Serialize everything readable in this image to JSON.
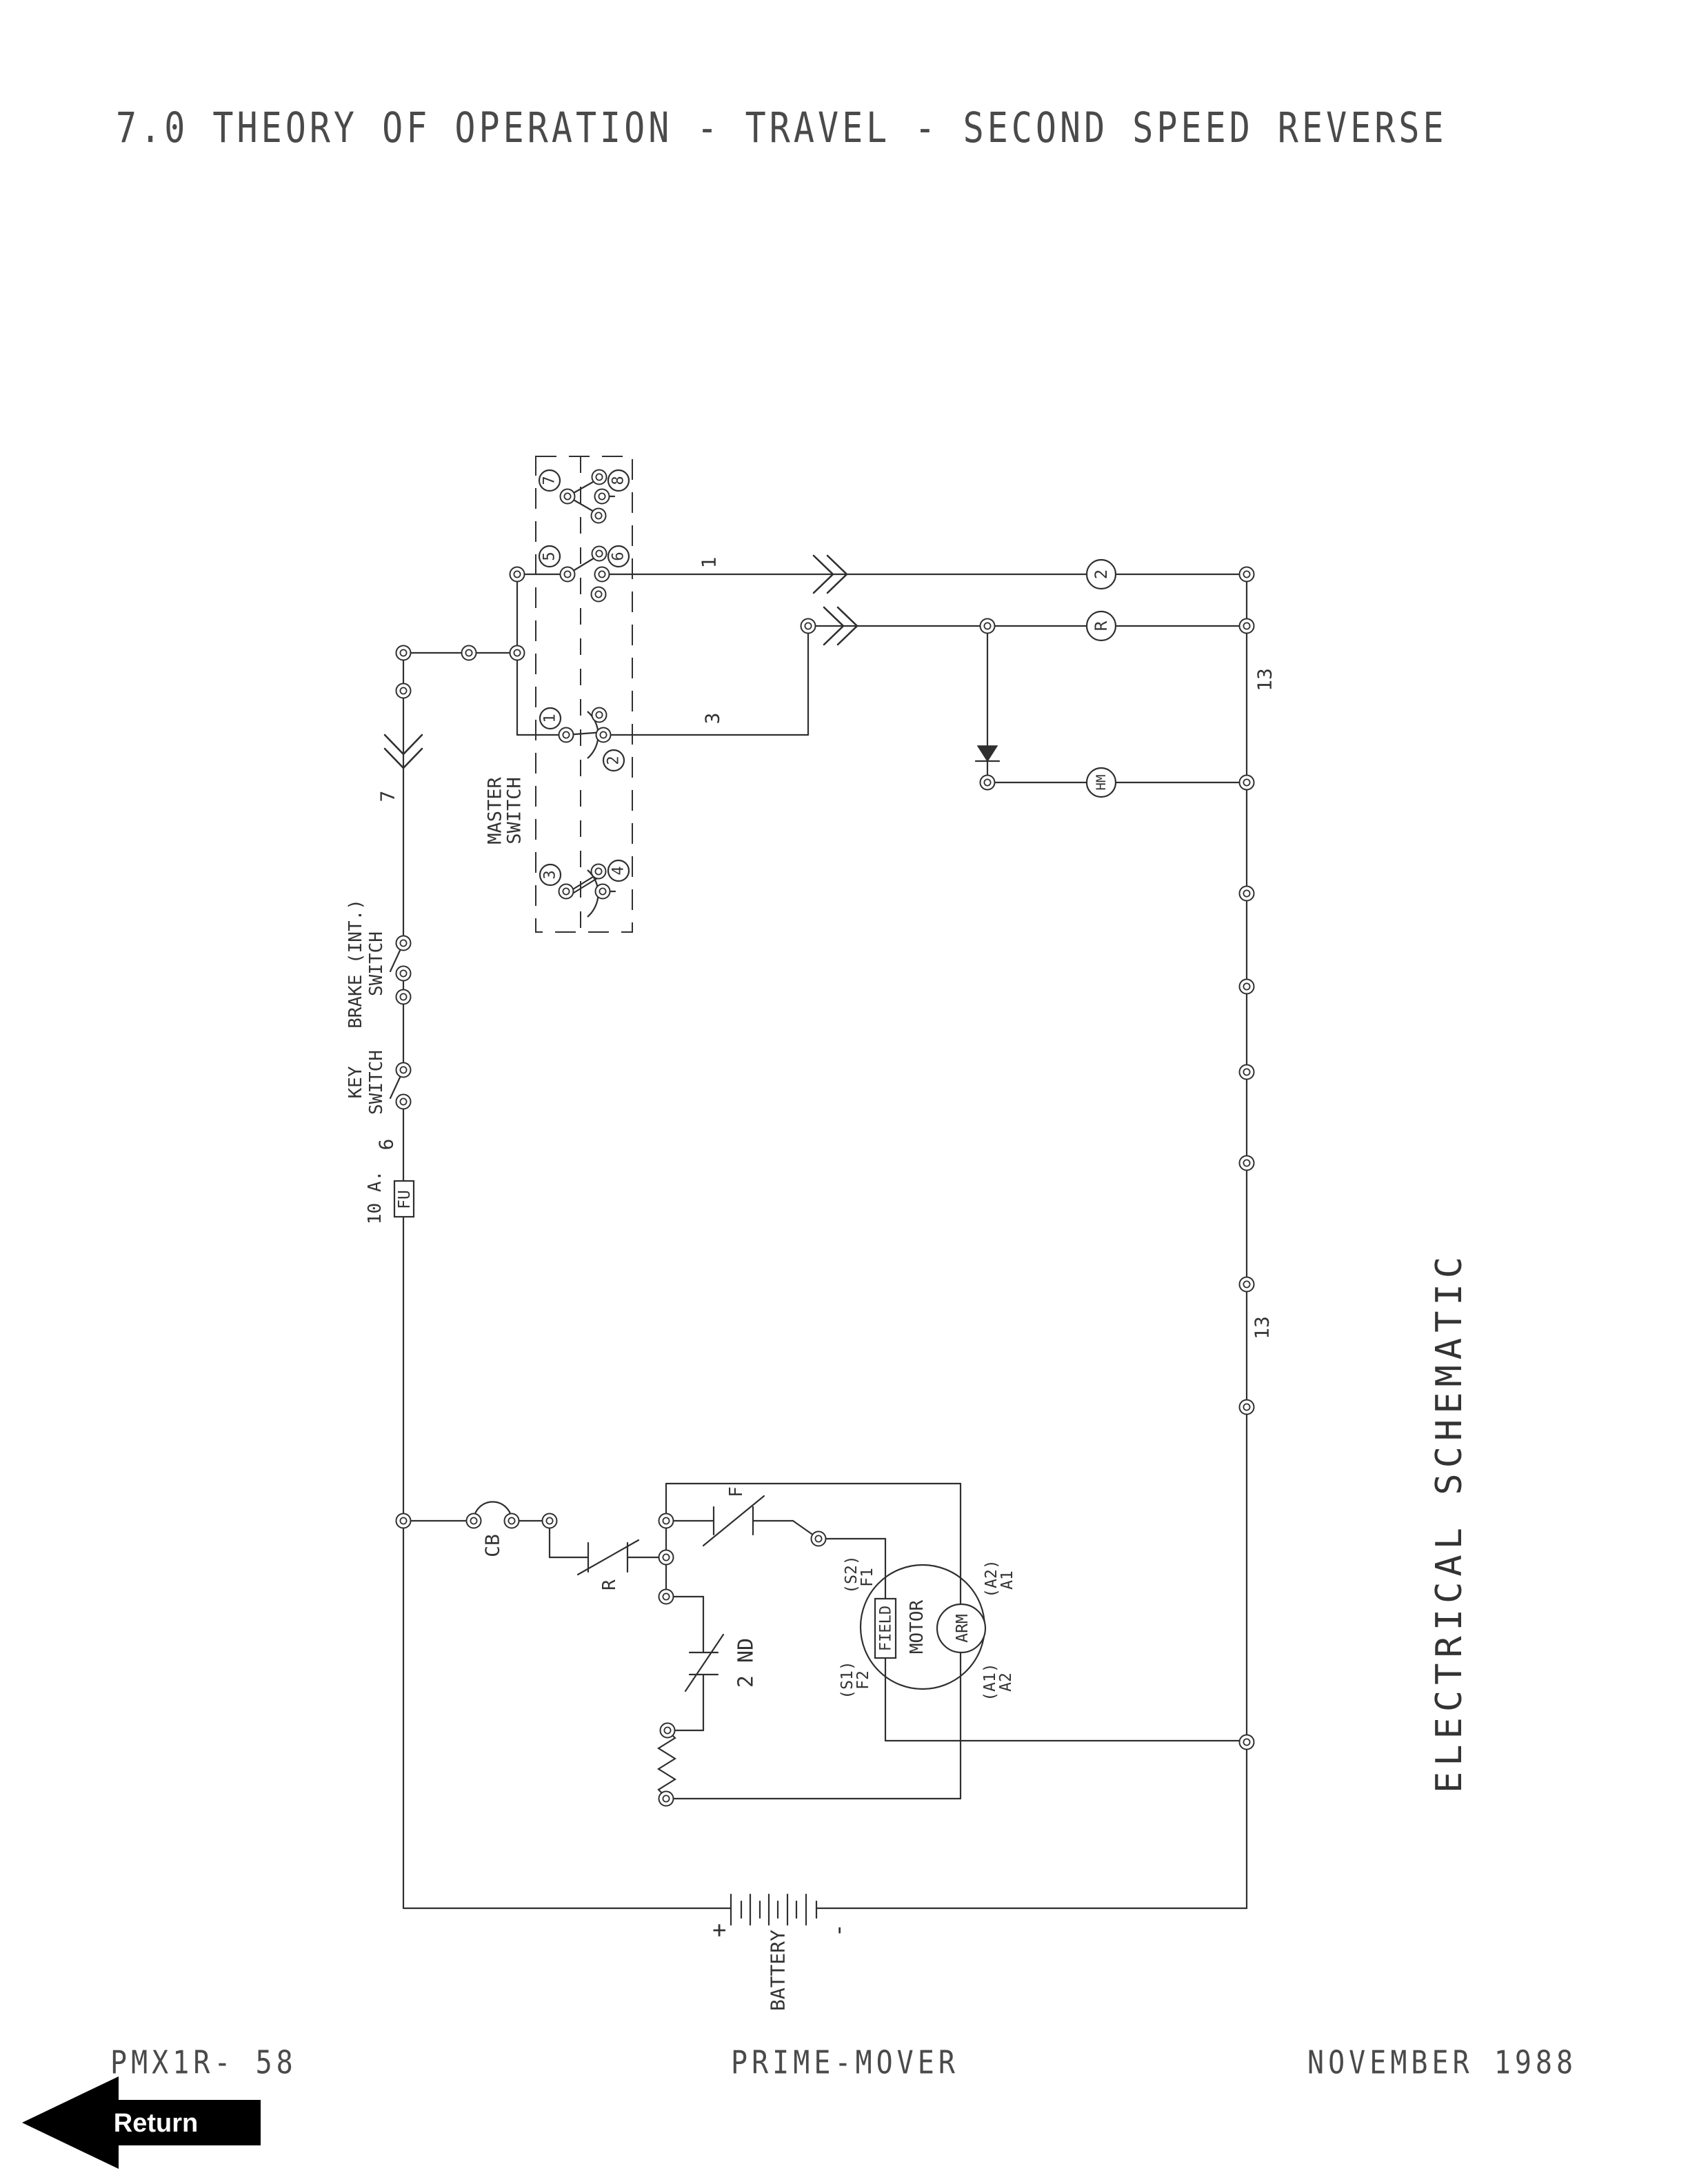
{
  "page": {
    "title": "7.0 THEORY OF OPERATION - TRAVEL - SECOND SPEED REVERSE"
  },
  "schematic": {
    "title_vertical": "ELECTRICAL SCHEMATIC",
    "master_switch": {
      "label1": "MASTER",
      "label2": "SWITCH",
      "contacts": [
        "7",
        "8",
        "5",
        "6",
        "1",
        "2",
        "3",
        "4"
      ]
    },
    "brake_switch": {
      "label1": "BRAKE (INT.)",
      "label2": "SWITCH"
    },
    "key_switch": {
      "label1": "KEY",
      "label2": "SWITCH"
    },
    "fuse": {
      "rating": "10 A.",
      "label": "FU"
    },
    "circuit_breaker": {
      "label": "CB"
    },
    "r_contact": {
      "label": "R"
    },
    "second_contact": {
      "label": "2 ND"
    },
    "f_contact": {
      "label": "F"
    },
    "coils": {
      "speed2": "2",
      "reverse": "R",
      "hourmeter": "HM"
    },
    "motor": {
      "label": "MOTOR",
      "field": "FIELD",
      "arm": "ARM",
      "s2": "(S2)",
      "f1": "F1",
      "s1": "(S1)",
      "f2": "F2",
      "a2_paren": "(A2)",
      "a1": "A1",
      "a1_paren": "(A1)",
      "a2": "A2"
    },
    "battery": {
      "label": "BATTERY",
      "plus": "+",
      "minus": "-"
    },
    "wires": {
      "w1": "1",
      "w3": "3",
      "w6": "6",
      "w7": "7",
      "w13": "13"
    }
  },
  "footer": {
    "doc_code": "PMX1R- 58",
    "product": "PRIME-MOVER",
    "date": "NOVEMBER 1988"
  },
  "return_button": {
    "label": "Return"
  }
}
